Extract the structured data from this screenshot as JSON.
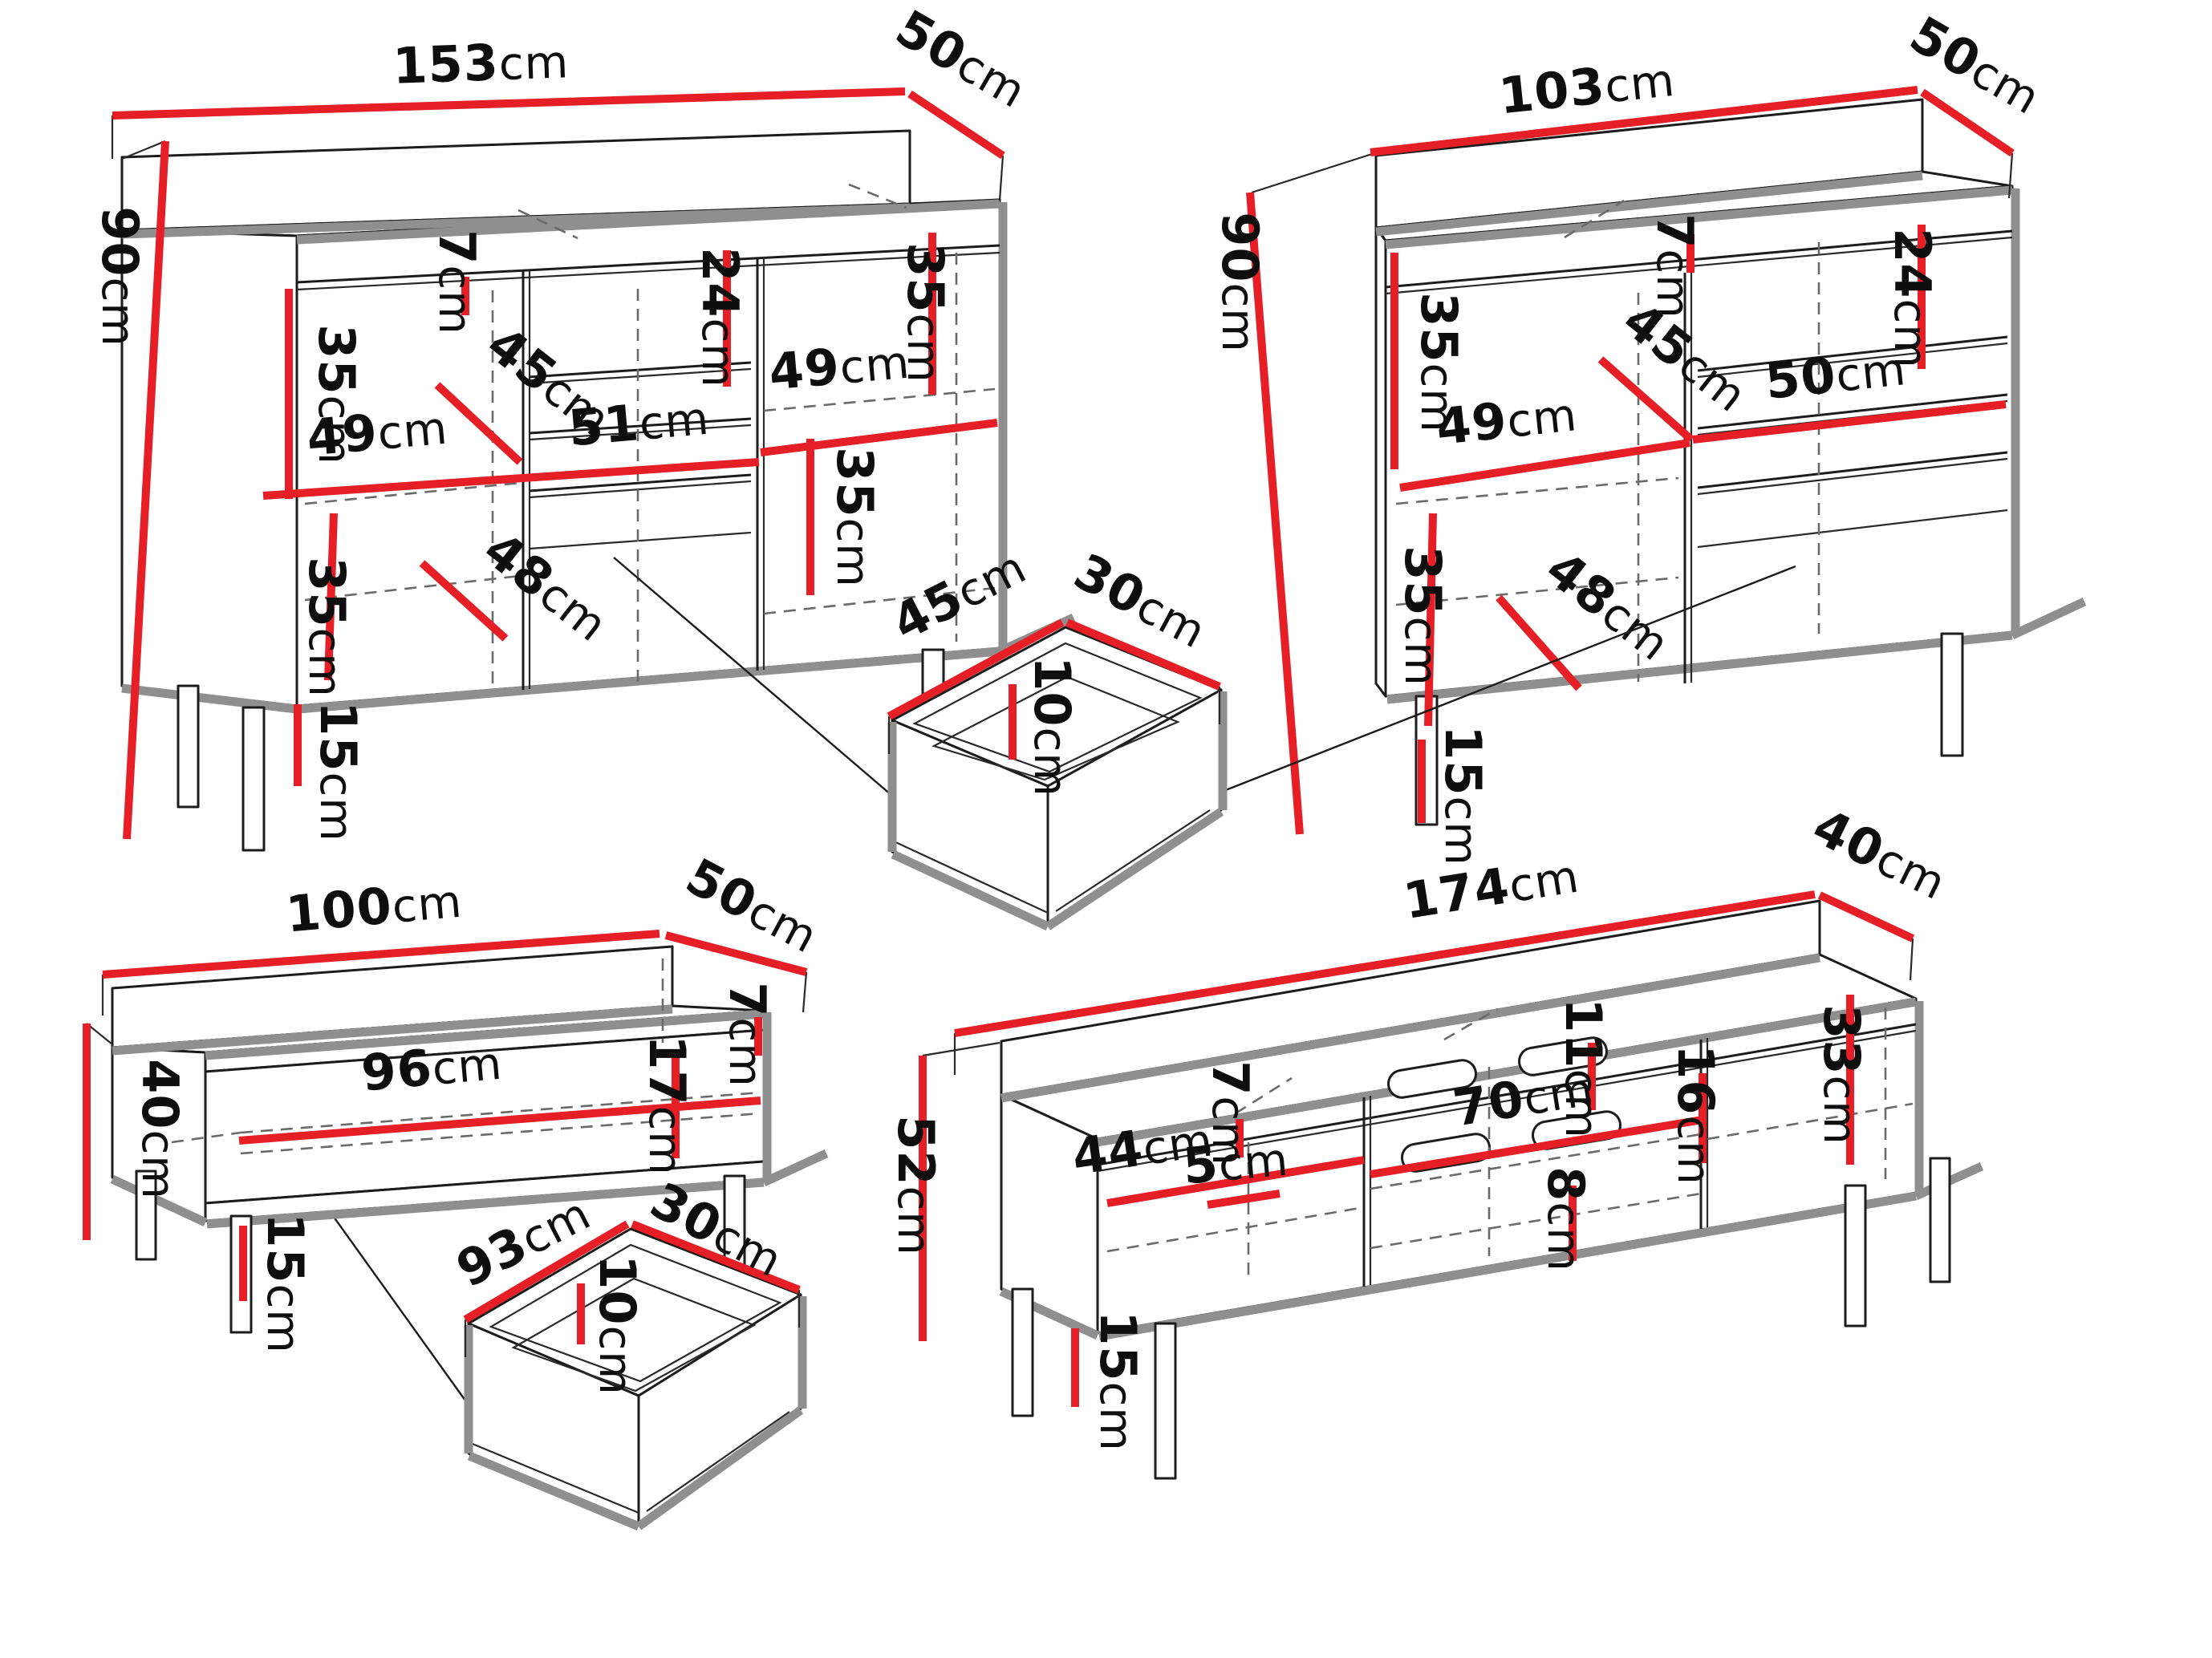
{
  "meta": {
    "background": "#ffffff",
    "dimension_line_color": "#e61e25",
    "outline_color": "#1c1c1c",
    "shadow_edge_color": "#8f8f8f",
    "unit": "cm"
  },
  "pieces": [
    {
      "id": "sideboard-153",
      "dims": {
        "width": {
          "num": "153",
          "unit": "cm"
        },
        "depth": {
          "num": "50",
          "unit": "cm"
        },
        "height": {
          "num": "90",
          "unit": "cm"
        },
        "top_rail": {
          "num": "7",
          "unit": "cm"
        },
        "shelf_top_left": {
          "num": "35",
          "unit": "cm"
        },
        "shelf_depth": {
          "num": "45",
          "unit": "cm"
        },
        "left_width": {
          "num": "49",
          "unit": "cm"
        },
        "center_width": {
          "num": "51",
          "unit": "cm"
        },
        "right_width": {
          "num": "49",
          "unit": "cm"
        },
        "top_drawer": {
          "num": "24",
          "unit": "cm"
        },
        "shelf_top_right": {
          "num": "35",
          "unit": "cm"
        },
        "shelf_low_right": {
          "num": "35",
          "unit": "cm"
        },
        "shelf_low_left": {
          "num": "35",
          "unit": "cm"
        },
        "shelf_low_depth": {
          "num": "48",
          "unit": "cm"
        },
        "legs": {
          "num": "15",
          "unit": "cm"
        }
      }
    },
    {
      "id": "sideboard-103",
      "dims": {
        "width": {
          "num": "103",
          "unit": "cm"
        },
        "depth": {
          "num": "50",
          "unit": "cm"
        },
        "height": {
          "num": "90",
          "unit": "cm"
        },
        "top_rail": {
          "num": "7",
          "unit": "cm"
        },
        "shelf_top_left": {
          "num": "35",
          "unit": "cm"
        },
        "shelf_depth": {
          "num": "45",
          "unit": "cm"
        },
        "left_width": {
          "num": "49",
          "unit": "cm"
        },
        "right_width": {
          "num": "50",
          "unit": "cm"
        },
        "top_drawer": {
          "num": "24",
          "unit": "cm"
        },
        "shelf_low_left": {
          "num": "35",
          "unit": "cm"
        },
        "shelf_low_depth": {
          "num": "48",
          "unit": "cm"
        },
        "legs": {
          "num": "15",
          "unit": "cm"
        }
      }
    },
    {
      "id": "drawer-45",
      "dims": {
        "width": {
          "num": "45",
          "unit": "cm"
        },
        "depth": {
          "num": "30",
          "unit": "cm"
        },
        "height": {
          "num": "10",
          "unit": "cm"
        }
      }
    },
    {
      "id": "coffee-table-100",
      "dims": {
        "width": {
          "num": "100",
          "unit": "cm"
        },
        "depth": {
          "num": "50",
          "unit": "cm"
        },
        "height": {
          "num": "40",
          "unit": "cm"
        },
        "inner_width": {
          "num": "96",
          "unit": "cm"
        },
        "top_rail": {
          "num": "7",
          "unit": "cm"
        },
        "inner_height": {
          "num": "17",
          "unit": "cm"
        },
        "legs": {
          "num": "15",
          "unit": "cm"
        }
      }
    },
    {
      "id": "drawer-93",
      "dims": {
        "width": {
          "num": "93",
          "unit": "cm"
        },
        "depth": {
          "num": "30",
          "unit": "cm"
        },
        "height": {
          "num": "10",
          "unit": "cm"
        }
      }
    },
    {
      "id": "tv-stand-174",
      "dims": {
        "width": {
          "num": "174",
          "unit": "cm"
        },
        "depth": {
          "num": "40",
          "unit": "cm"
        },
        "height": {
          "num": "52",
          "unit": "cm"
        },
        "left_door_width": {
          "num": "44",
          "unit": "cm"
        },
        "top_rail": {
          "num": "7",
          "unit": "cm"
        },
        "center_width": {
          "num": "70",
          "unit": "cm"
        },
        "bottom_gap": {
          "num": "5",
          "unit": "cm"
        },
        "slot_top": {
          "num": "11",
          "unit": "cm"
        },
        "slot_mid": {
          "num": "16",
          "unit": "cm"
        },
        "slot_bottom": {
          "num": "8",
          "unit": "cm"
        },
        "right_door_height": {
          "num": "33",
          "unit": "cm"
        },
        "legs": {
          "num": "15",
          "unit": "cm"
        }
      }
    }
  ]
}
